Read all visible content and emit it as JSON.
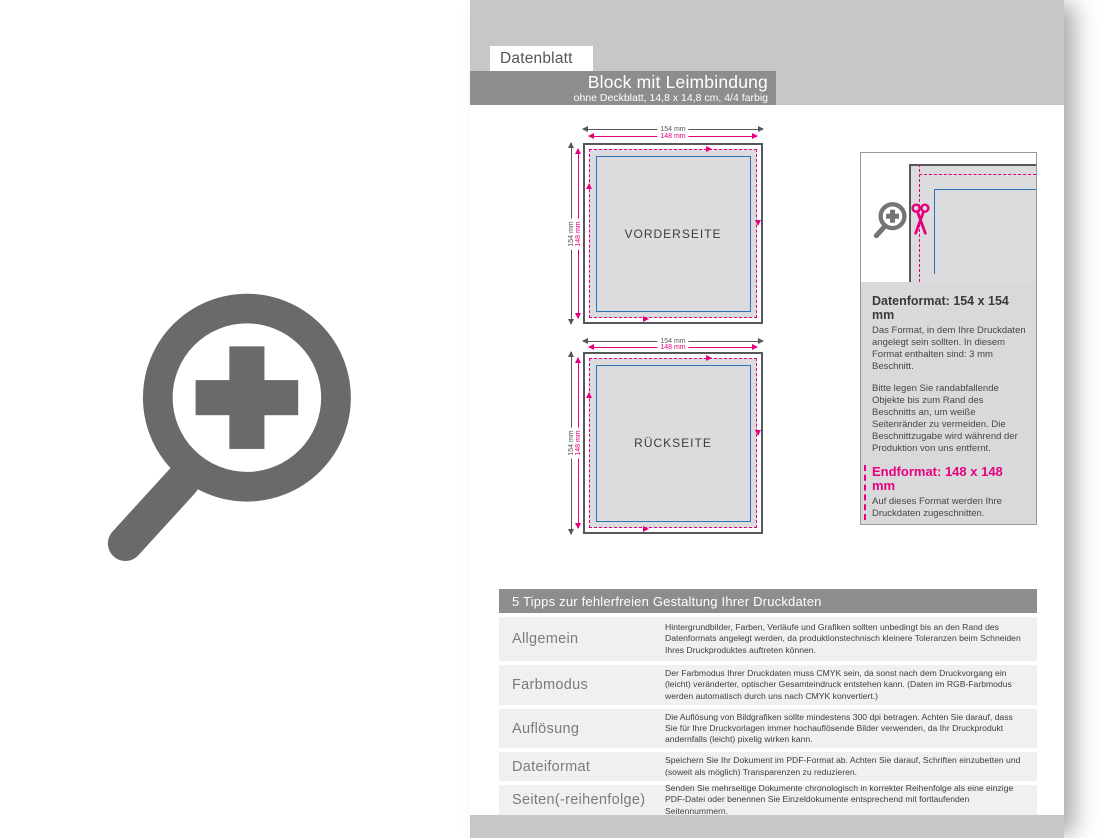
{
  "header": {
    "tab": "Datenblatt",
    "title": "Block mit Leimbindung",
    "subtitle": "ohne Deckblatt, 14,8 x 14,8 cm, 4/4 farbig"
  },
  "diagrams": {
    "front_label": "VORDERSEITE",
    "back_label": "RÜCKSEITE",
    "outer_size": "154 mm",
    "inner_size": "148 mm"
  },
  "infobox": {
    "datenformat": {
      "heading": "Datenformat: 154 x 154 mm",
      "p1": "Das Format, in dem Ihre Druckdaten angelegt sein sollten. In diesem Format enthalten sind: 3 mm Beschnitt.",
      "p2": "Bitte legen Sie randabfallende Objekte bis zum Rand des Beschnitts an, um weiße Seitenränder zu vermeiden. Die Beschnittzugabe wird während der Produktion von uns entfernt."
    },
    "endformat": {
      "heading": "Endformat: 148 x 148 mm",
      "text": "Auf dieses Format werden Ihre Druckdaten zugeschnitten."
    },
    "sicherheitsabstand": {
      "heading": "Sicherheitsabstand: 3 mm",
      "text": "Dieser wird vom Endformat aus gemessen und verhindert unerwünschten Anschnitt Ihrer Texte und Informationen während der Produktion."
    }
  },
  "tips": {
    "title": "5 Tipps zur fehlerfreien Gestaltung Ihrer Druckdaten",
    "rows": [
      {
        "label": "Allgemein",
        "text": "Hintergrundbilder, Farben, Verläufe und Grafiken sollten unbedingt bis an den Rand des Datenformats angelegt werden, da produktionstechnisch kleinere Toleranzen beim Schneiden Ihres Druckproduktes auftreten können."
      },
      {
        "label": "Farbmodus",
        "text": "Der Farbmodus Ihrer Druckdaten muss CMYK sein, da sonst nach dem Druckvorgang ein (leicht) veränderter, optischer Gesamteindruck entstehen kann. (Daten im RGB-Farbmodus werden automatisch durch uns nach CMYK konvertiert.)"
      },
      {
        "label": "Auflösung",
        "text": "Die Auflösung von Bildgrafiken sollte mindestens 300 dpi betragen. Achten Sie darauf, dass Sie für Ihre Druckvorlagen immer hochauflösende Bilder verwenden, da Ihr Druckprodukt andernfalls (leicht) pixelig wirken kann."
      },
      {
        "label": "Dateiformat",
        "text": "Speichern Sie Ihr Dokument im PDF-Format ab. Achten Sie darauf, Schriften einzubetten und (soweit als möglich) Transparenzen zu reduzieren."
      },
      {
        "label": "Seiten(-reihenfolge)",
        "text": "Senden Sie mehrseitige Dokumente chronologisch in korrekter Reihenfolge als eine einzige PDF-Datei oder benennen Sie Einzeldokumente entsprechend mit fortlaufenden Seitennummern."
      }
    ]
  },
  "icons": {
    "left_icon": "zoom-plus-icon",
    "infobox_magnifier": "zoom-plus-icon",
    "infobox_scissors": "scissors-icon"
  },
  "colors": {
    "band_gray": "#c7c7c9",
    "banner_gray": "#8d8d90",
    "outline_dark": "#56575b",
    "fill_light": "#dcdcdf",
    "magenta": "#e6007e",
    "blue": "#2e74b5",
    "row_bg": "#f0f0f1",
    "infobox_text_bg": "#d9d9db",
    "icon_gray": "#696a6c"
  }
}
